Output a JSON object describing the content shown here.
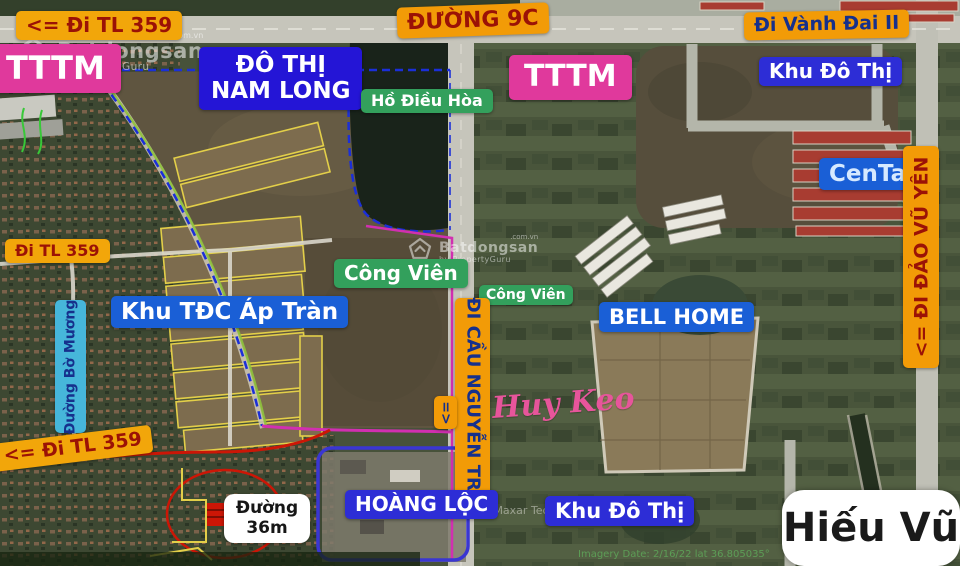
{
  "watermark": {
    "brand": "Batdongsan",
    "domain": ".com.vn",
    "byline": "by PropertyGuru"
  },
  "credits": {
    "maxar": "Image ©2021 Maxar Tech",
    "imagery": "Imagery Date: 2/16/22   lat 36.805035°"
  },
  "signature": "Hiếu Vũ",
  "labels": {
    "tl359_top": "<=  Đi TL 359",
    "duong_9c": "ĐƯỜNG 9C",
    "vanh_dai": "Đi Vành Đai II",
    "tttm_left": "TTTM",
    "tttm_center": "TTTM",
    "do_thi_nam_long_line1": "ĐÔ THỊ",
    "do_thi_nam_long_line2": "NAM LONG",
    "ho_dieu_hoa": "Hồ Điều Hòa",
    "khu_do_thi_top": "Khu Đô Thị",
    "centa": "CenTa",
    "di_dao_vu_yen": "<=  ĐI ĐẢO VŨ YÊN",
    "di_tl359_left": "Đi TL 359",
    "duong_bo_muong": "Đường Bờ Mương",
    "khu_tdc_ap_tran": "Khu TĐC Áp Tràn",
    "cong_vien_main": "Công Viên",
    "cong_vien_small": "Công Viên",
    "bell_home": "BELL HOME",
    "di_cau_nguyen_trai": "ĐI CẦU NGUYỄN TRÃI",
    "arrow_down": "=>",
    "huy_keo": "Huy Keo",
    "tl359_bottom": "<= Đi TL 359",
    "hoang_loc": "HOÀNG LỘC",
    "khu_do_thi_bottom": "Khu Đô Thị",
    "duong_36m_line1": "Đường",
    "duong_36m_line2": "36m"
  },
  "colors": {
    "badgeYellow": "#f2a60a",
    "badgeOrange": "#f29b07",
    "badgePink": "#e0399c",
    "badgeBlueDeep": "#2415d6",
    "badgeBlue": "#1a5fd6",
    "badgeIndigo": "#2d2dd6",
    "badgeGreen": "#33a05c",
    "badgeCyan": "#46b6da",
    "textRed": "#9b1206",
    "textNavy": "#16308c",
    "accentMagenta": "#d12fb0",
    "accentBlueDash": "#1b2fd8",
    "accentRed": "#cc1606",
    "plotYellow": "#e3cf49",
    "handwritingPink": "#e7559b"
  }
}
